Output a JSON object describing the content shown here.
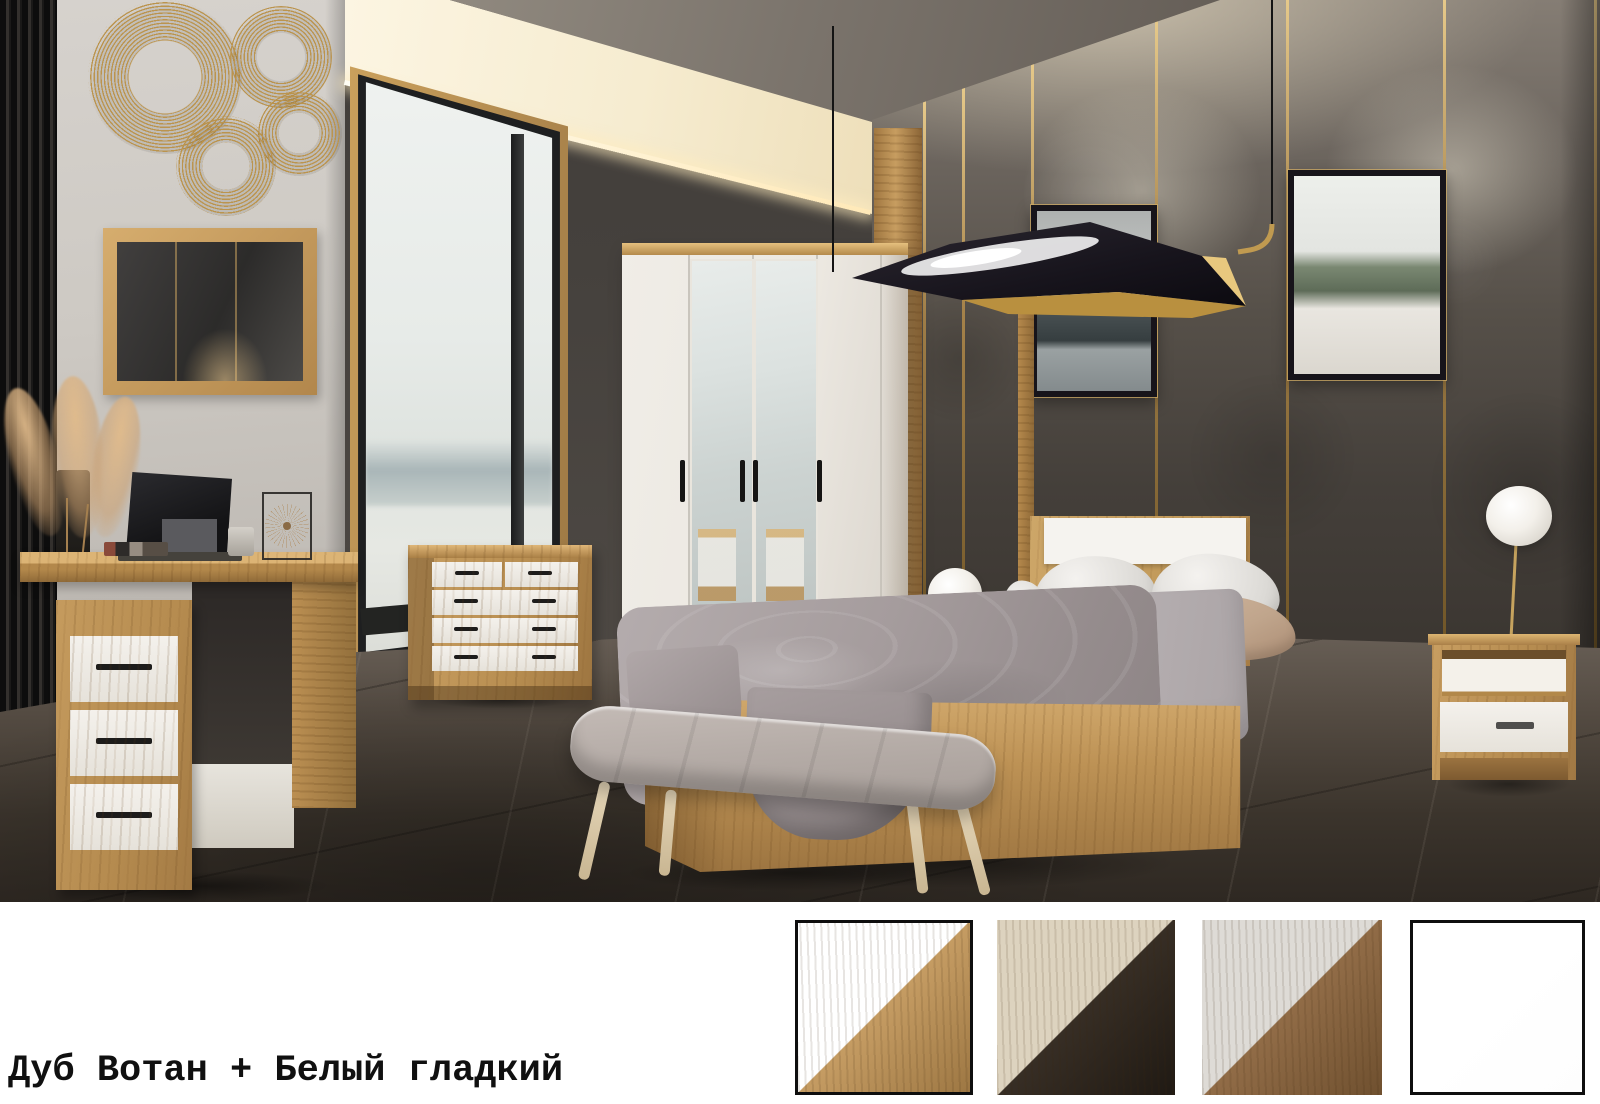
{
  "caption": {
    "text": "Дуб Вотан + Белый гладкий"
  },
  "finish_swatches": [
    {
      "top_color": "#ffffff",
      "bottom_color": "#c59c63",
      "bottom_color_deep": "#9d7743",
      "bordered": true,
      "grain": true
    },
    {
      "top_color": "#ddd3bf",
      "bottom_color": "#372e25",
      "bottom_color_deep": "#1f1913",
      "bordered": false,
      "grain": true
    },
    {
      "top_color": "#dedbd6",
      "bottom_color": "#916c47",
      "bottom_color_deep": "#6f502f",
      "bordered": false,
      "grain": true
    },
    {
      "top_color": "#ffffff",
      "bottom_color": "#ffffff",
      "bottom_color_deep": "#fdfdfd",
      "bordered": true,
      "grain": false
    }
  ],
  "palette": {
    "oak": "#c49a5f",
    "oak_dark": "#8d6839",
    "oak_light": "#dcb273",
    "furniture_white": "#f1eee8",
    "handle_black": "#1d1c1b",
    "wall_grey": "#cdc9c3",
    "wall_dark": "#45413d",
    "wall_right_dark": "#3b3631",
    "gold": "#c29c58",
    "floor_dark": "#332c26",
    "ceiling": "#7b746c",
    "cove_glow": "#f7ecd0",
    "sky": "#e9edeb",
    "bedding_grey": "#b0a8a8",
    "pillow_beige": "#c3a88f",
    "bench_grey": "#b0a7a2",
    "lamp_white": "#f7f5f1",
    "caption_text": "#101010",
    "band_background": "#ffffff"
  },
  "scene": {
    "items": [
      "black slat wall panel",
      "gold rings wall decor",
      "oak framed mirror",
      "desk with three white drawers",
      "laptop",
      "pampas grass in vase",
      "wire decor piece",
      "floor-to-ceiling window",
      "chest of drawers",
      "four-door wardrobe with two mirror doors",
      "double bed with oak frame and white headboard insert",
      "upholstered bench",
      "two nightstands",
      "two white ball lamps",
      "black and gold pendant lamp",
      "two framed forest pictures",
      "gold wall strips"
    ]
  }
}
